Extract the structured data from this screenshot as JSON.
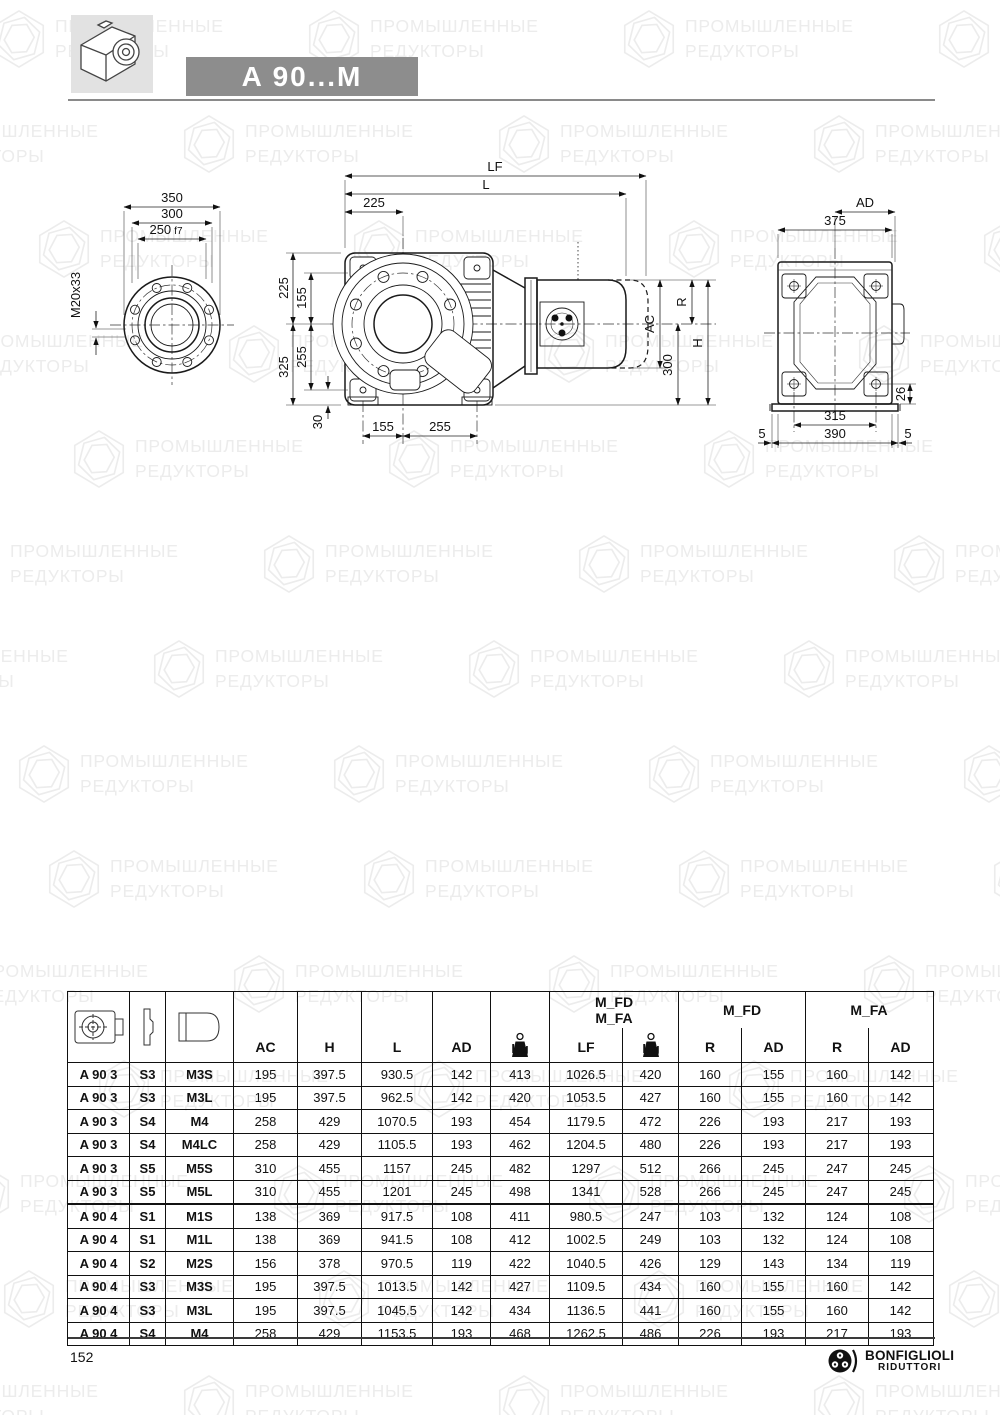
{
  "header": {
    "title": "A 90...M"
  },
  "watermark": {
    "line1": "ПРОМЫШЛЕННЫЕ",
    "line2": "РЕДУКТОРЫ"
  },
  "drawings": {
    "front": {
      "d350": "350",
      "d300": "300",
      "d250": "250",
      "d250s": "f7",
      "m20": "M20x33"
    },
    "side": {
      "lf": "LF",
      "l": "L",
      "d225t": "225",
      "d225": "225",
      "d155": "155",
      "d255": "255",
      "d325": "325",
      "d30": "30",
      "d155b": "155",
      "d255b": "255",
      "r": "R",
      "ac": "AC",
      "d300": "300",
      "h": "H"
    },
    "rear": {
      "ad": "AD",
      "d375": "375",
      "d315": "315",
      "d390": "390",
      "d5l": "5",
      "d5r": "5",
      "d26": "26"
    }
  },
  "table": {
    "groups": {
      "g1a": "M_FD",
      "g1b": "M_FA",
      "g2": "M_FD",
      "g3": "M_FA"
    },
    "cols": {
      "ac": "AC",
      "h": "H",
      "l": "L",
      "ad": "AD",
      "kg": "Kg",
      "lf": "LF",
      "r1": "R",
      "ad1": "AD",
      "r2": "R",
      "ad2": "AD"
    },
    "rows": [
      [
        "A 90 3",
        "S3",
        "M3S",
        "195",
        "397.5",
        "930.5",
        "142",
        "413",
        "1026.5",
        "420",
        "160",
        "155",
        "160",
        "142"
      ],
      [
        "A 90 3",
        "S3",
        "M3L",
        "195",
        "397.5",
        "962.5",
        "142",
        "420",
        "1053.5",
        "427",
        "160",
        "155",
        "160",
        "142"
      ],
      [
        "A 90 3",
        "S4",
        "M4",
        "258",
        "429",
        "1070.5",
        "193",
        "454",
        "1179.5",
        "472",
        "226",
        "193",
        "217",
        "193"
      ],
      [
        "A 90 3",
        "S4",
        "M4LC",
        "258",
        "429",
        "1105.5",
        "193",
        "462",
        "1204.5",
        "480",
        "226",
        "193",
        "217",
        "193"
      ],
      [
        "A 90 3",
        "S5",
        "M5S",
        "310",
        "455",
        "1157",
        "245",
        "482",
        "1297",
        "512",
        "266",
        "245",
        "247",
        "245"
      ],
      [
        "A 90 3",
        "S5",
        "M5L",
        "310",
        "455",
        "1201",
        "245",
        "498",
        "1341",
        "528",
        "266",
        "245",
        "247",
        "245"
      ],
      [
        "A 90 4",
        "S1",
        "M1S",
        "138",
        "369",
        "917.5",
        "108",
        "411",
        "980.5",
        "247",
        "103",
        "132",
        "124",
        "108"
      ],
      [
        "A 90 4",
        "S1",
        "M1L",
        "138",
        "369",
        "941.5",
        "108",
        "412",
        "1002.5",
        "249",
        "103",
        "132",
        "124",
        "108"
      ],
      [
        "A 90 4",
        "S2",
        "M2S",
        "156",
        "378",
        "970.5",
        "119",
        "422",
        "1040.5",
        "426",
        "129",
        "143",
        "134",
        "119"
      ],
      [
        "A 90 4",
        "S3",
        "M3S",
        "195",
        "397.5",
        "1013.5",
        "142",
        "427",
        "1109.5",
        "434",
        "160",
        "155",
        "160",
        "142"
      ],
      [
        "A 90 4",
        "S3",
        "M3L",
        "195",
        "397.5",
        "1045.5",
        "142",
        "434",
        "1136.5",
        "441",
        "160",
        "155",
        "160",
        "142"
      ],
      [
        "A 90 4",
        "S4",
        "M4",
        "258",
        "429",
        "1153.5",
        "193",
        "468",
        "1262.5",
        "486",
        "226",
        "193",
        "217",
        "193"
      ]
    ]
  },
  "footer": {
    "page": "152",
    "brand1": "BONFIGLIOLI",
    "brand2": "RIDUTTORI"
  }
}
